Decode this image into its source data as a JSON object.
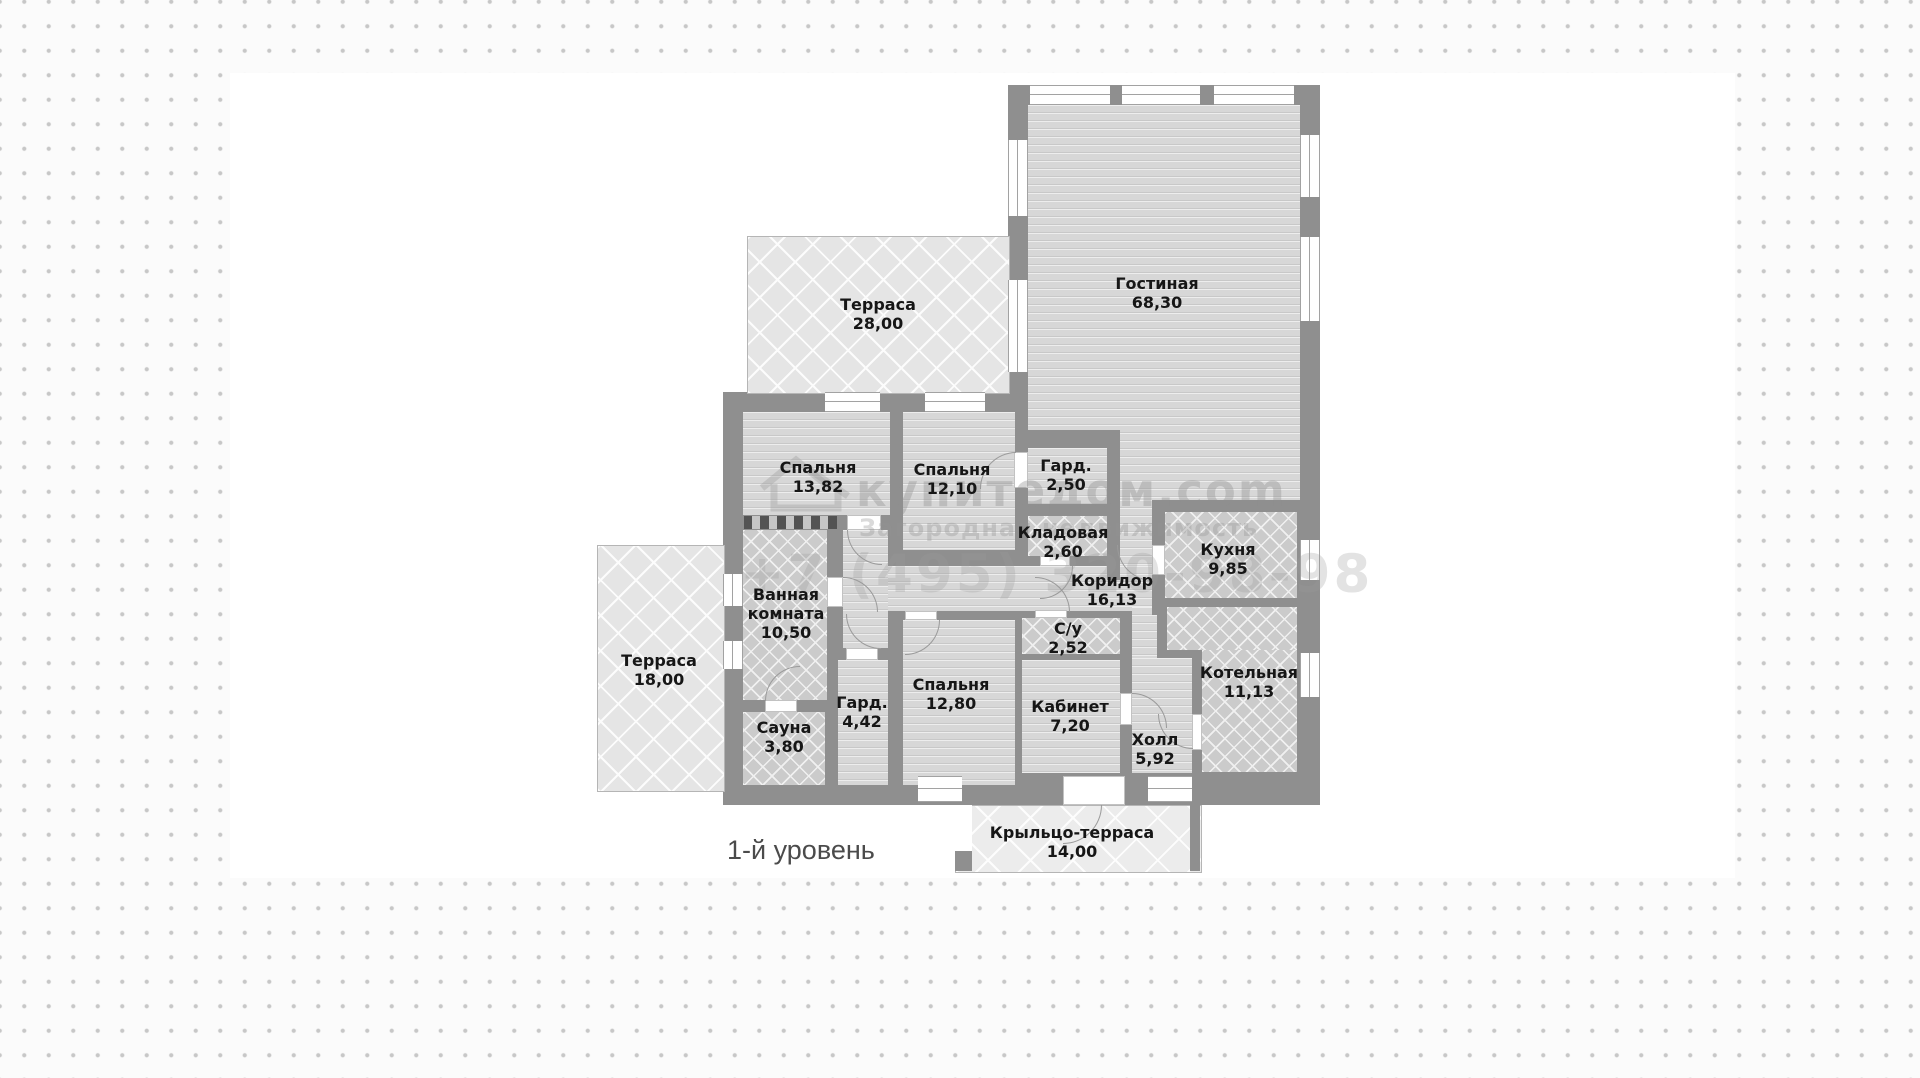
{
  "level_label": "1-й уровень",
  "watermark": {
    "brand": "купитедом.com",
    "tagline": "Загородная недвижимость",
    "phone": "+7 (495) 320-98-98"
  },
  "palette": {
    "wall": "#8f8f8f",
    "floor_stripes": "#d7d7d7",
    "floor_tile": "#cbcbcb",
    "terrace": "#e5e5e5",
    "label_text": "#161616",
    "background_dot": "#c7c7c7",
    "plate": "#ffffff"
  },
  "rooms": [
    {
      "id": "terrace-28",
      "name": "Терраса",
      "area": "28,00"
    },
    {
      "id": "living",
      "name": "Гостиная",
      "area": "68,30"
    },
    {
      "id": "bedroom-1382",
      "name": "Спальня",
      "area": "13,82"
    },
    {
      "id": "bedroom-1210",
      "name": "Спальня",
      "area": "12,10"
    },
    {
      "id": "ward-250",
      "name": "Гард.",
      "area": "2,50"
    },
    {
      "id": "storage",
      "name": "Кладовая",
      "area": "2,60"
    },
    {
      "id": "kitchen",
      "name": "Кухня",
      "area": "9,85"
    },
    {
      "id": "corridor",
      "name": "Коридор",
      "area": "16,13"
    },
    {
      "id": "bathroom",
      "name": "Ванная комната",
      "area": "10,50"
    },
    {
      "id": "terrace-18",
      "name": "Терраса",
      "area": "18,00"
    },
    {
      "id": "wc",
      "name": "С/у",
      "area": "2,52"
    },
    {
      "id": "boiler",
      "name": "Котельная",
      "area": "11,13"
    },
    {
      "id": "sauna",
      "name": "Сауна",
      "area": "3,80"
    },
    {
      "id": "ward-442",
      "name": "Гард.",
      "area": "4,42"
    },
    {
      "id": "bedroom-1280",
      "name": "Спальня",
      "area": "12,80"
    },
    {
      "id": "office",
      "name": "Кабинет",
      "area": "7,20"
    },
    {
      "id": "hall",
      "name": "Холл",
      "area": "5,92"
    },
    {
      "id": "porch",
      "name": "Крыльцо-терраса",
      "area": "14,00"
    }
  ]
}
